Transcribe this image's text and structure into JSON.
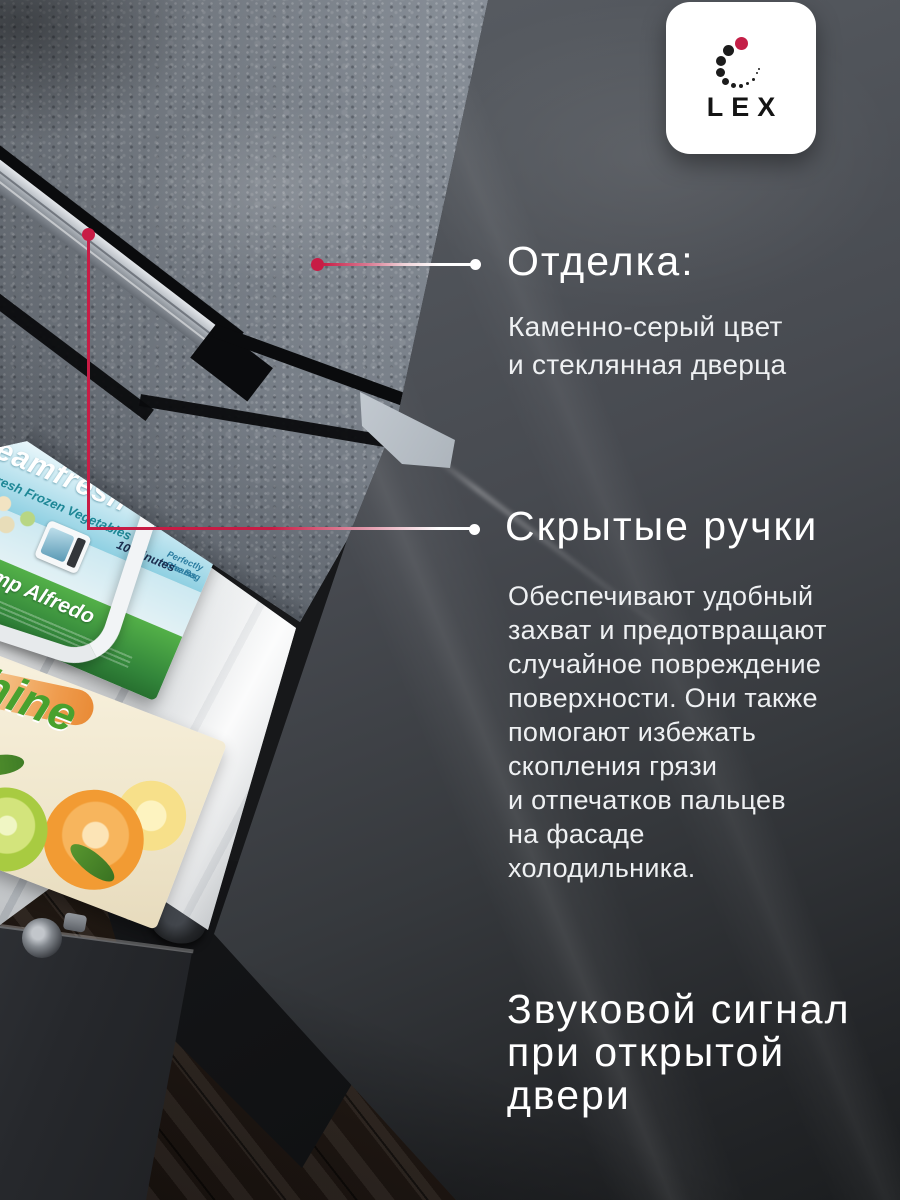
{
  "card": {
    "language": "ru"
  },
  "brand": {
    "logo_text": "LEX"
  },
  "colors": {
    "accent_red": "#c81c45",
    "logo_red": "#c41f47",
    "door_grey": "#4a4e54",
    "stone_grey": "#7a828b",
    "heading_white": "#ffffff",
    "body_white": "#eef0f2"
  },
  "callouts": [
    {
      "id": "finish",
      "title": "Отделка:",
      "body": "Каменно-серый цвет\nи стеклянная дверца"
    },
    {
      "id": "hidden_handles",
      "title": "Скрытые ручки",
      "body": "Обеспечивают удобный\nзахват и предотвращают\nслучайное повреждение\nповерхности. Они также\nпомогают избежать\nскопления грязи\nи отпечатков пальцев\nна фасаде\nхолодильника."
    },
    {
      "id": "door_alarm",
      "title": "Звуковой сигнал\nпри открытой\nдвери"
    }
  ],
  "photo_labels": {
    "steamfresh_box": {
      "brand_script": "eamfresh",
      "tagline": "Fresh Frozen Vegetables",
      "claim_line1": "Perfectly Steams",
      "claim_line2": "in the Bag",
      "claim_badge": "10 Minutes",
      "flavor": "Shrimp Alfredo"
    },
    "citrus_box": {
      "brand_fragment": "hine"
    }
  }
}
